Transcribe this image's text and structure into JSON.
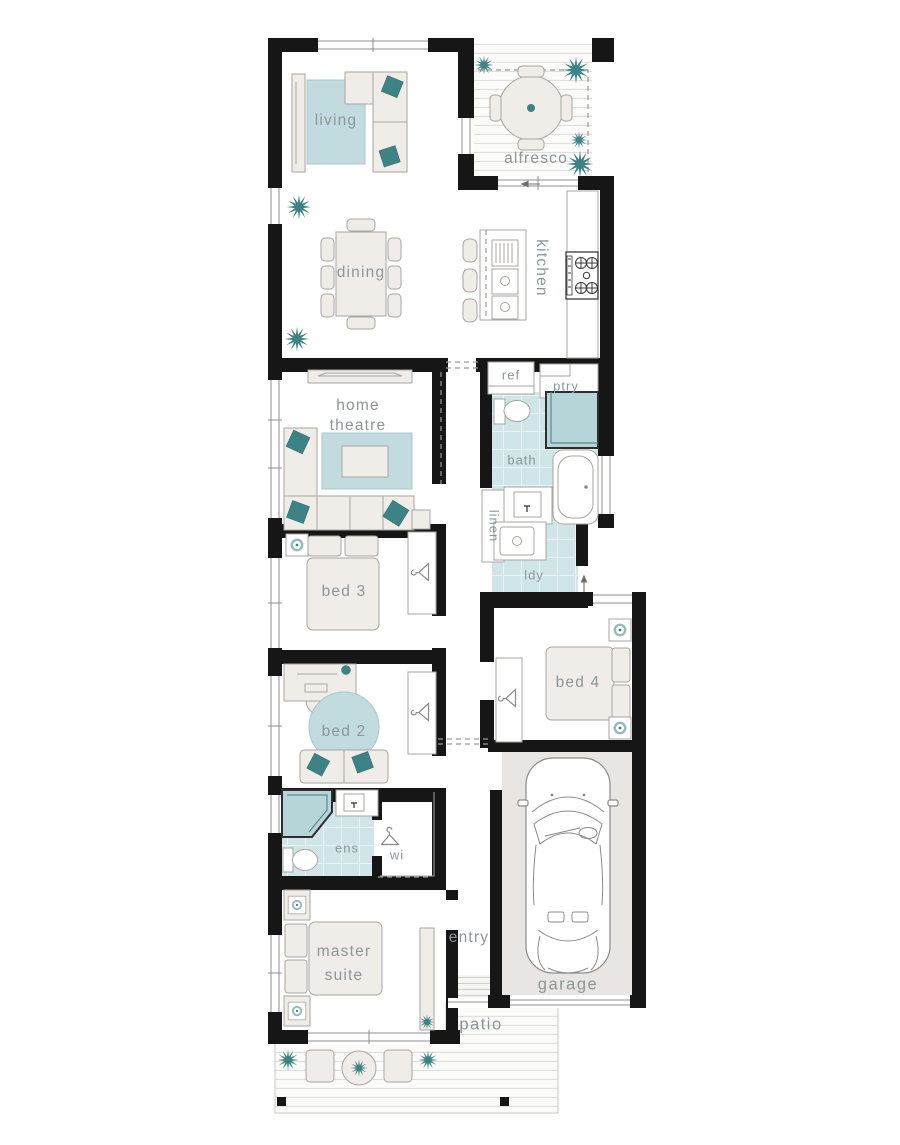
{
  "title": "single storey home floor plan",
  "colors": {
    "wall": "#161616",
    "accent_teal": "#3d8285",
    "rug_teal": "#c2dbde",
    "wet_floor_teal": "#cfe5e7",
    "shower_teal": "#b5d5d8",
    "furniture_fill": "#f0ede8",
    "furniture_stroke": "#a8a6a1",
    "garage_floor": "#e8e5e2",
    "deck_line": "#dcdcd9",
    "label_text": "#8d9699"
  },
  "icons": {
    "plant": "teal starburst shrub",
    "hanger": "clothes hanger (wardrobe)",
    "lamp": "square side table with teal ring lamp",
    "car": "sedan top view",
    "cooktop": "5-burner gas cooktop",
    "arrow": "entry direction arrow"
  },
  "rooms": {
    "living": {
      "label": "living"
    },
    "alfresco": {
      "label": "alfresco"
    },
    "dining": {
      "label": "dining"
    },
    "kitchen": {
      "label": "kitchen"
    },
    "ref": {
      "label": "ref"
    },
    "pantry": {
      "label": "ptry"
    },
    "home_theatre": {
      "label_line1": "home",
      "label_line2": "theatre"
    },
    "bath": {
      "label": "bath"
    },
    "linen": {
      "label": "linen"
    },
    "laundry": {
      "label": "ldy"
    },
    "bed3": {
      "label": "bed 3"
    },
    "bed4": {
      "label": "bed 4"
    },
    "bed2": {
      "label": "bed 2"
    },
    "ensuite": {
      "label": "ens"
    },
    "walk_in_robe": {
      "label": "wi"
    },
    "master_suite": {
      "label_line1": "master",
      "label_line2": "suite"
    },
    "entry": {
      "label": "entry"
    },
    "garage": {
      "label": "garage"
    },
    "patio": {
      "label": "patio"
    }
  }
}
